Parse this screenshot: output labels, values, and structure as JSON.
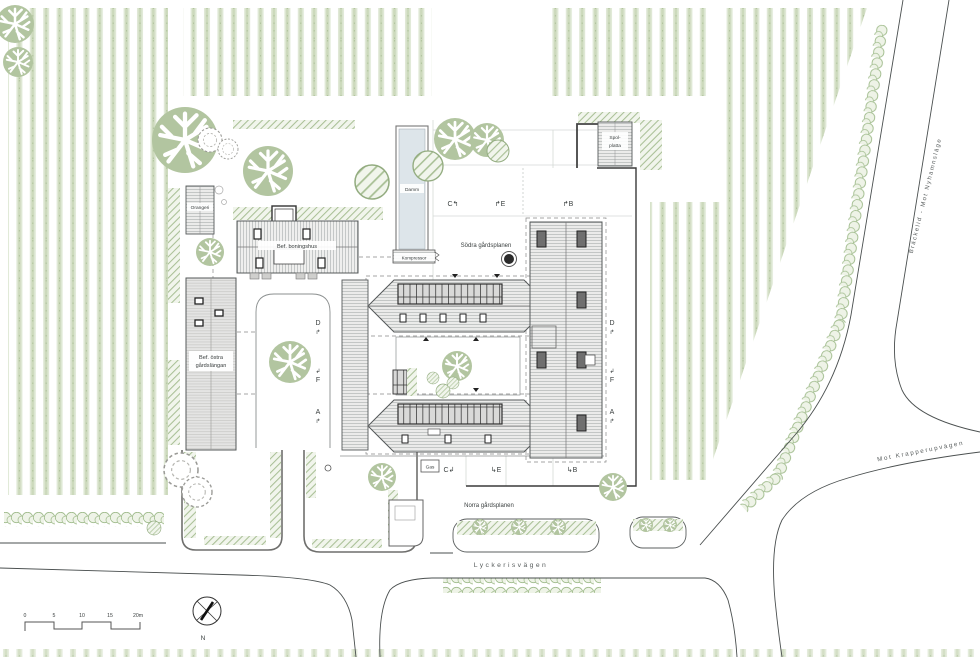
{
  "buildings": {
    "orangeri": "Orangeri",
    "boningshus": "Bef. boningshus",
    "ostra_line1": "Bef. östra",
    "ostra_line2": "gårdslängan",
    "damm": "Damm",
    "kompressor": "Kompressor",
    "spolplatta_line1": "Spol-",
    "spolplatta_line2": "platta",
    "gas": "Gas"
  },
  "areas": {
    "sodra": "Södra gårdsplanen",
    "norra": "Norra gårdsplanen"
  },
  "roads": {
    "lyckerisvagen": "Lyckerisvägen",
    "brackelid": "Bräckelid - Mot Nyhamnsläge",
    "krapperup": "Mot Krapperupvägen"
  },
  "sections": {
    "c_top": "C↰",
    "e_top": "↱E",
    "b_top": "↱B",
    "c_bottom": "C↲",
    "e_bottom": "↳E",
    "b_bottom": "↳B",
    "d": "D",
    "f": "F",
    "a": "A",
    "arrow_up": "↱",
    "arrow_down": "↲"
  },
  "scale_bar": {
    "ticks": [
      "0",
      "5",
      "10",
      "15",
      "20m"
    ]
  },
  "compass": {
    "north": "N"
  },
  "palette": {
    "crop_green": "#dfe8d5",
    "tree_green": "#b2c5a0",
    "hatch_green": "#a9c096",
    "roof_gray": "#ebebea",
    "water_blue": "#dde5ea",
    "line_gray": "#4a4f4f"
  }
}
